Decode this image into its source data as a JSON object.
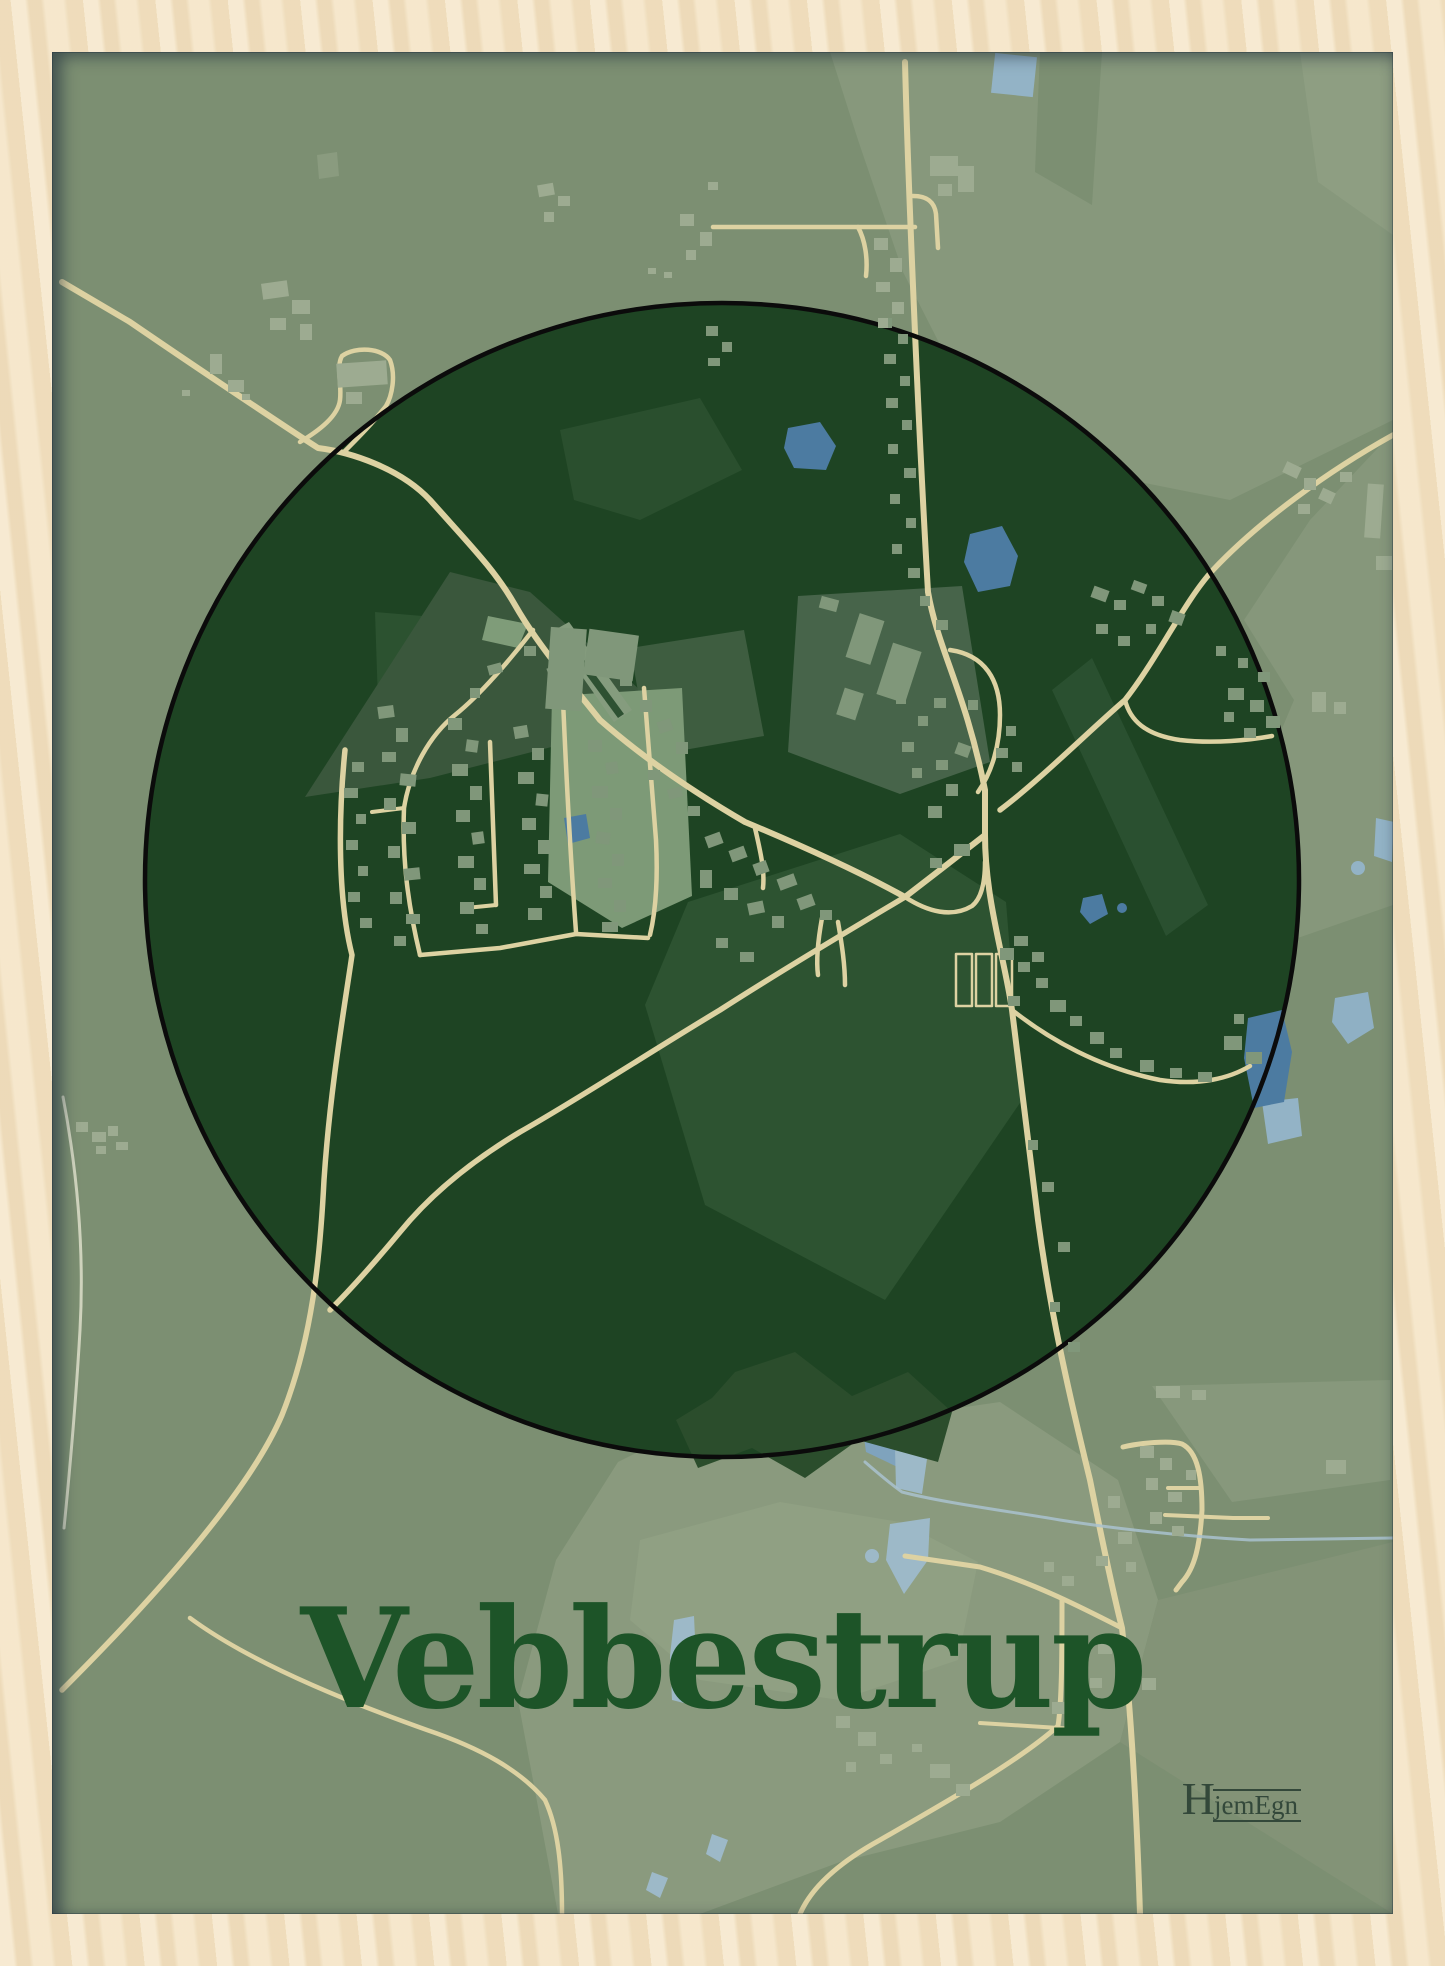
{
  "poster": {
    "title": "Vebbestrup",
    "brand": {
      "initial": "H",
      "rest": "jemEgn"
    }
  },
  "colors": {
    "frame_wood": "#f3e2c3",
    "map_background": "#7c8f72",
    "field_light": "#87987c",
    "field_lighter": "#90a083",
    "circle_fill": "#1e4423",
    "circle_outline": "#0b0b0b",
    "circle_patch_medium": "#3e5d40",
    "circle_patch_light": "#7d9a77",
    "road": "#ddd2a2",
    "path_pale": "#cfd3bd",
    "building_inside_circle": "#80977a",
    "building_outside_circle": "#9dab91",
    "water_dark": "#4c7ba1",
    "water_light": "#93b3c6",
    "title_text": "#1d5428",
    "logo_text": "#33483a"
  }
}
